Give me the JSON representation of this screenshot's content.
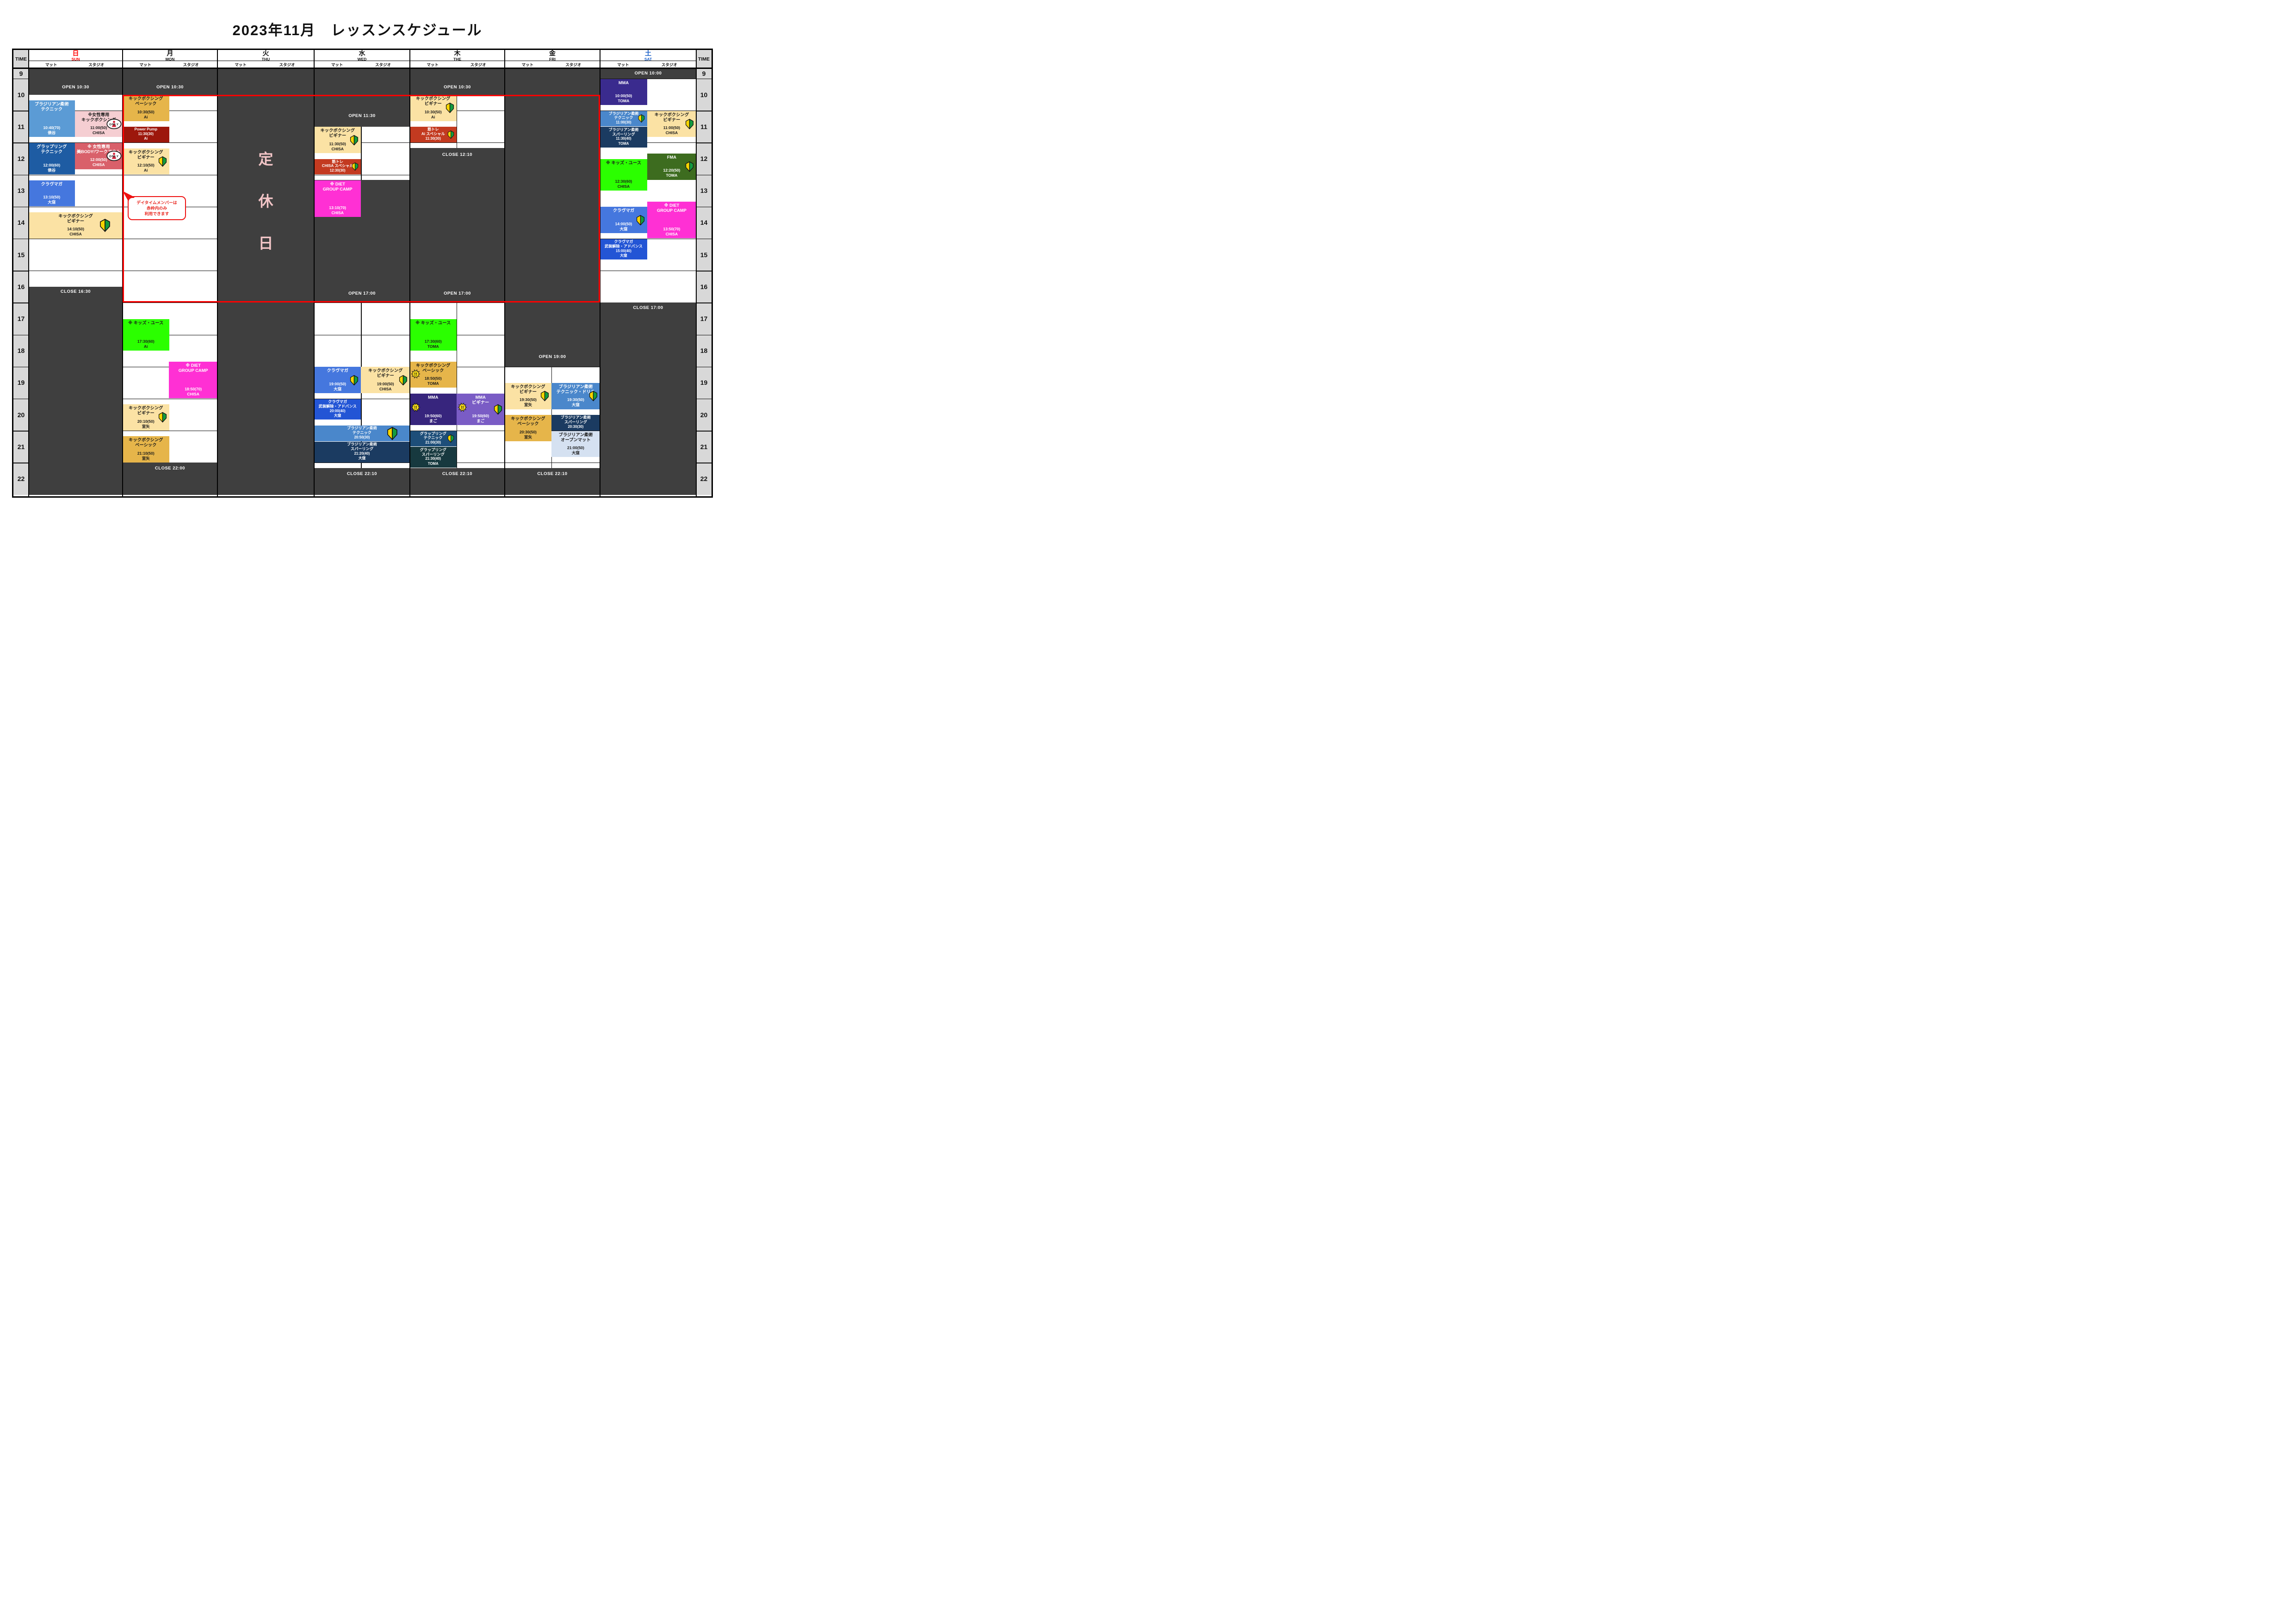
{
  "title": "2023年11月　レッスンスケジュール",
  "header": {
    "time_label": "TIME",
    "mat_label": "マット",
    "studio_label": "スタジオ"
  },
  "hours": [
    9,
    10,
    11,
    12,
    13,
    14,
    15,
    16,
    17,
    18,
    19,
    20,
    21,
    22
  ],
  "colors": {
    "dark_cell": "#3F3F3F",
    "time_col_bg": "#D8D8D8",
    "grid_line": "#101010",
    "red_frame": "#FF0000",
    "holiday_text": "#F2C5C7",
    "beginner_yellow": "#F7D500",
    "beginner_green": "#149B3E",
    "bang_yellow": "#FFE11A",
    "only_red": "#D7263D"
  },
  "icons": {
    "only_text": "ONLY",
    "bang_text": "!!"
  },
  "holiday": {
    "text": "定休日"
  },
  "callout": {
    "lines": [
      "デイタイムメンバーは",
      "赤枠内のみ",
      "利用できます"
    ],
    "color": "#E8231B"
  },
  "red_frame_note": {
    "from_day": "mon",
    "to_day": "fri",
    "from_time": 10.5,
    "to_time": 17
  },
  "days": [
    {
      "key": "sun",
      "name": "日",
      "en": "SUN",
      "name_color": "#FF0000",
      "holiday": false,
      "dark_bands": [
        [
          9,
          10.5
        ],
        [
          16.5,
          23
        ]
      ],
      "labels": [
        {
          "text": "OPEN 10:30",
          "t": 10.28
        },
        {
          "text": "CLOSE 16:30",
          "t": 16.66
        }
      ],
      "dividers": [],
      "events": [
        {
          "col": "mat",
          "t": 10.667,
          "dur": 70,
          "bg": "#5B9BD5",
          "fg": "#FFFFFF",
          "title": [
            "ブラジリアン柔術",
            "テクニック"
          ],
          "time": "10:40(70)",
          "who": "俵谷",
          "icons": [],
          "compact": false
        },
        {
          "col": "studio",
          "t": 11.0,
          "dur": 50,
          "bg": "#F5CED2",
          "fg": "#1A1A1A",
          "title": [
            "※女性専用",
            "キックボクシング"
          ],
          "time": "11:00(50)",
          "who": "CHISA",
          "icons": [
            "only"
          ],
          "compact": false
        },
        {
          "col": "mat",
          "t": 12.0,
          "dur": 60,
          "bg": "#1E5CA3",
          "fg": "#FFFFFF",
          "title": [
            "グラップリング",
            "テクニック"
          ],
          "time": "12:00(60)",
          "who": "俵谷",
          "icons": [],
          "compact": false
        },
        {
          "col": "studio",
          "t": 12.0,
          "dur": 50,
          "bg": "#D9606A",
          "fg": "#FFFFFF",
          "title": [
            "※ 女性専用",
            "美BODY!ワークアウト"
          ],
          "time": "12:00(50)",
          "who": "CHISA",
          "icons": [
            "only"
          ],
          "compact": false
        },
        {
          "col": "mat",
          "t": 13.167,
          "dur": 50,
          "bg": "#4577DE",
          "fg": "#FFFFFF",
          "title": [
            "クラヴマガ"
          ],
          "time": "13:10(50)",
          "who": "大窪",
          "icons": [],
          "compact": false
        },
        {
          "col": "full",
          "t": 14.167,
          "dur": 50,
          "bg": "#FBE2A4",
          "fg": "#1A1A1A",
          "title": [
            "キックボクシング",
            "ビギナー"
          ],
          "time": "14:10(50)",
          "who": "CHISA",
          "icons": [
            "beginner"
          ],
          "compact": false
        }
      ]
    },
    {
      "key": "mon",
      "name": "月",
      "en": "MON",
      "name_color": "#111111",
      "holiday": false,
      "dark_bands": [
        [
          9,
          10.5
        ],
        [
          22,
          23
        ]
      ],
      "labels": [
        {
          "text": "OPEN 10:30",
          "t": 10.28
        },
        {
          "text": "CLOSE 22:00",
          "t": 22.18
        }
      ],
      "dividers": [],
      "events": [
        {
          "col": "mat",
          "t": 10.5,
          "dur": 50,
          "bg": "#E6B54A",
          "fg": "#1A1A1A",
          "title": [
            "キックボクシング",
            "ベーシック"
          ],
          "time": "10:30(50)",
          "who": "Ai",
          "icons": [],
          "compact": false
        },
        {
          "col": "mat",
          "t": 11.5,
          "dur": 30,
          "bg": "#9D170C",
          "fg": "#FFFFFF",
          "title": [
            "Power Pump"
          ],
          "time": "11:30(30)",
          "who": "Ai",
          "icons": [],
          "compact": true
        },
        {
          "col": "mat",
          "t": 12.167,
          "dur": 50,
          "bg": "#FBE2A4",
          "fg": "#1A1A1A",
          "title": [
            "キックボクシング",
            "ビギナー"
          ],
          "time": "12:10(50)",
          "who": "Ai",
          "icons": [
            "beginner"
          ],
          "compact": false
        },
        {
          "col": "mat",
          "t": 17.5,
          "dur": 60,
          "bg": "#2BFF00",
          "fg": "#1A1A1A",
          "title": [
            "※ キッズ・ユース"
          ],
          "time": "17:30(60)",
          "who": "Ai",
          "icons": [],
          "compact": false
        },
        {
          "col": "studio",
          "t": 18.833,
          "dur": 70,
          "bg": "#FF30D4",
          "fg": "#FFFFFF",
          "title": [
            "※ DIET",
            "GROUP CAMP"
          ],
          "time": "18:50(70)",
          "who": "CHISA",
          "icons": [],
          "compact": false
        },
        {
          "col": "mat",
          "t": 20.167,
          "dur": 50,
          "bg": "#FBE2A4",
          "fg": "#1A1A1A",
          "title": [
            "キックボクシング",
            "ビギナー"
          ],
          "time": "20:10(50)",
          "who": "室矢",
          "icons": [
            "beginner"
          ],
          "compact": false
        },
        {
          "col": "mat",
          "t": 21.167,
          "dur": 50,
          "bg": "#E6B54A",
          "fg": "#1A1A1A",
          "title": [
            "キックボクシング",
            "ベーシック"
          ],
          "time": "21:10(50)",
          "who": "室矢",
          "icons": [],
          "compact": false
        }
      ]
    },
    {
      "key": "tue",
      "name": "火",
      "en": "THU",
      "name_color": "#111111",
      "holiday": true,
      "dark_bands": [
        [
          9,
          23
        ]
      ],
      "labels": [],
      "dividers": [],
      "events": []
    },
    {
      "key": "wed",
      "name": "水",
      "en": "WED",
      "name_color": "#111111",
      "holiday": false,
      "dark_bands": [
        [
          9,
          11.5
        ],
        [
          13.167,
          17
        ],
        [
          22.167,
          23
        ]
      ],
      "labels": [
        {
          "text": "OPEN 11:30",
          "t": 11.17
        },
        {
          "text": "OPEN 17:00",
          "t": 16.72
        },
        {
          "text": "CLOSE 22:10",
          "t": 22.35
        }
      ],
      "dividers": [
        [
          11.5,
          13.167
        ],
        [
          17,
          22.167
        ]
      ],
      "events": [
        {
          "col": "mat",
          "t": 11.5,
          "dur": 50,
          "bg": "#FBE2A4",
          "fg": "#1A1A1A",
          "title": [
            "キックボクシング",
            "ビギナー"
          ],
          "time": "11:30(50)",
          "who": "CHISA",
          "icons": [
            "beginner"
          ],
          "compact": false
        },
        {
          "col": "mat",
          "t": 12.5,
          "dur": 30,
          "bg": "#C33A20",
          "fg": "#FFFFFF",
          "title": [
            "筋トレ",
            "CHISA スペシャル"
          ],
          "time": "12:30(30)",
          "who": "",
          "icons": [
            "beginner"
          ],
          "compact": true
        },
        {
          "col": "mat",
          "t": 13.167,
          "dur": 70,
          "bg": "#FF30D4",
          "fg": "#FFFFFF",
          "title": [
            "※ DIET",
            "GROUP CAMP"
          ],
          "time": "13:10(70)",
          "who": "CHISA",
          "icons": [],
          "compact": false
        },
        {
          "col": "mat",
          "t": 19.0,
          "dur": 50,
          "bg": "#4577DE",
          "fg": "#FFFFFF",
          "title": [
            "クラヴマガ"
          ],
          "time": "19:00(50)",
          "who": "大窪",
          "icons": [
            "beginner"
          ],
          "compact": false
        },
        {
          "col": "studio",
          "t": 19.0,
          "dur": 50,
          "bg": "#FBE2A4",
          "fg": "#1A1A1A",
          "title": [
            "キックボクシング",
            "ビギナー"
          ],
          "time": "19:00(50)",
          "who": "CHISA",
          "icons": [
            "beginner"
          ],
          "compact": false
        },
        {
          "col": "mat",
          "t": 20.0,
          "dur": 40,
          "bg": "#2355D5",
          "fg": "#FFFFFF",
          "title": [
            "クラヴマガ",
            "武装解除・アドバンス"
          ],
          "time": "20:00(40)",
          "who": "大窪",
          "icons": [],
          "compact": true
        },
        {
          "col": "full",
          "t": 20.833,
          "dur": 30,
          "bg": "#4A87CB",
          "fg": "#FFFFFF",
          "title": [
            "ブラジリアン柔術",
            "テクニック"
          ],
          "time": "20:50(30)",
          "who": "",
          "icons": [
            "beginner"
          ],
          "compact": true
        },
        {
          "col": "full",
          "t": 21.333,
          "dur": 40,
          "bg": "#1B3B61",
          "fg": "#FFFFFF",
          "title": [
            "ブラジリアン柔術",
            "スパーリング"
          ],
          "time": "21:20(40)",
          "who": "大窪",
          "icons": [],
          "compact": true
        }
      ]
    },
    {
      "key": "thu",
      "name": "木",
      "en": "THE",
      "name_color": "#111111",
      "holiday": false,
      "dark_bands": [
        [
          9,
          10.5
        ],
        [
          12.167,
          17
        ],
        [
          22.167,
          23
        ]
      ],
      "labels": [
        {
          "text": "OPEN 10:30",
          "t": 10.28
        },
        {
          "text": "CLOSE 12:10",
          "t": 12.38
        },
        {
          "text": "OPEN 17:00",
          "t": 16.72
        },
        {
          "text": "CLOSE 22:10",
          "t": 22.35
        }
      ],
      "dividers": [
        [
          10.5,
          12.167
        ],
        [
          17,
          22.167
        ]
      ],
      "events": [
        {
          "col": "mat",
          "t": 10.5,
          "dur": 50,
          "bg": "#FBE2A4",
          "fg": "#1A1A1A",
          "title": [
            "キックボクシング",
            "ビギナー"
          ],
          "time": "10:30(50)",
          "who": "Ai",
          "icons": [
            "beginner"
          ],
          "compact": false
        },
        {
          "col": "mat",
          "t": 11.5,
          "dur": 30,
          "bg": "#C33A20",
          "fg": "#FFFFFF",
          "title": [
            "筋トレ",
            "Ai スペシャル"
          ],
          "time": "11:30(30)",
          "who": "",
          "icons": [
            "beginner"
          ],
          "compact": true
        },
        {
          "col": "mat",
          "t": 17.5,
          "dur": 60,
          "bg": "#2BFF00",
          "fg": "#1A1A1A",
          "title": [
            "※ キッズ・ユース"
          ],
          "time": "17:30(60)",
          "who": "TOMA",
          "icons": [],
          "compact": false
        },
        {
          "col": "mat",
          "t": 18.833,
          "dur": 50,
          "bg": "#E6B54A",
          "fg": "#1A1A1A",
          "title": [
            "キックボクシング",
            "ベーシック"
          ],
          "time": "18:50(50)",
          "who": "TOMA",
          "icons": [
            "bang"
          ],
          "compact": false
        },
        {
          "col": "mat",
          "t": 19.833,
          "dur": 60,
          "bg": "#37257D",
          "fg": "#FFFFFF",
          "title": [
            "MMA"
          ],
          "time": "19:50(60)",
          "who": "まご",
          "icons": [
            "bang"
          ],
          "compact": false
        },
        {
          "col": "studio",
          "t": 19.833,
          "dur": 60,
          "bg": "#7A5CC5",
          "fg": "#FFFFFF",
          "title": [
            "MMA",
            "ビギナー"
          ],
          "time": "19:50(60)",
          "who": "まご",
          "icons": [
            "bang",
            "beginner"
          ],
          "compact": false
        },
        {
          "col": "mat",
          "t": 21.0,
          "dur": 30,
          "bg": "#1D4E79",
          "fg": "#FFFFFF",
          "title": [
            "グラップリング",
            "テクニック"
          ],
          "time": "21:00(30)",
          "who": "",
          "icons": [
            "beginner"
          ],
          "compact": true
        },
        {
          "col": "mat",
          "t": 21.5,
          "dur": 40,
          "bg": "#17393F",
          "fg": "#FFFFFF",
          "title": [
            "グラップリング",
            "スパーリング"
          ],
          "time": "21:30(40)",
          "who": "TOMA",
          "icons": [],
          "compact": true
        }
      ]
    },
    {
      "key": "fri",
      "name": "金",
      "en": "FRI",
      "name_color": "#111111",
      "holiday": false,
      "dark_bands": [
        [
          9,
          19
        ],
        [
          22.167,
          23
        ]
      ],
      "labels": [
        {
          "text": "OPEN 19:00",
          "t": 18.7
        },
        {
          "text": "CLOSE 22:10",
          "t": 22.35
        }
      ],
      "dividers": [
        [
          19,
          22.167
        ]
      ],
      "events": [
        {
          "col": "mat",
          "t": 19.5,
          "dur": 50,
          "bg": "#FBE2A4",
          "fg": "#1A1A1A",
          "title": [
            "キックボクシング",
            "ビギナー"
          ],
          "time": "19:30(50)",
          "who": "室矢",
          "icons": [
            "beginner"
          ],
          "compact": false
        },
        {
          "col": "studio",
          "t": 19.5,
          "dur": 50,
          "bg": "#4A87CB",
          "fg": "#FFFFFF",
          "title": [
            "ブラジリアン柔術",
            "テクニック・ドリル"
          ],
          "time": "19:30(50)",
          "who": "大窪",
          "icons": [
            "beginner"
          ],
          "compact": false
        },
        {
          "col": "mat",
          "t": 20.5,
          "dur": 50,
          "bg": "#E6B54A",
          "fg": "#1A1A1A",
          "title": [
            "キックボクシング",
            "ベーシック"
          ],
          "time": "20:30(50)",
          "who": "室矢",
          "icons": [],
          "compact": false
        },
        {
          "col": "studio",
          "t": 20.5,
          "dur": 30,
          "bg": "#1B3B61",
          "fg": "#FFFFFF",
          "title": [
            "ブラジリアン柔術",
            "スパーリング"
          ],
          "time": "20:30(30)",
          "who": "",
          "icons": [],
          "compact": true
        },
        {
          "col": "studio",
          "t": 21.0,
          "dur": 50,
          "bg": "#D5E1F1",
          "fg": "#1A1A1A",
          "title": [
            "ブラジリアン柔術",
            "オープンマット"
          ],
          "time": "21:00(50)",
          "who": "大窪",
          "icons": [],
          "compact": false
        }
      ]
    },
    {
      "key": "sat",
      "name": "土",
      "en": "SAT",
      "name_color": "#1A5FC8",
      "holiday": false,
      "dark_bands": [
        [
          9,
          10
        ],
        [
          17,
          23
        ]
      ],
      "labels": [
        {
          "text": "OPEN 10:00",
          "t": 9.5
        },
        {
          "text": "CLOSE 17:00",
          "t": 17.16
        }
      ],
      "dividers": [],
      "events": [
        {
          "col": "mat",
          "t": 10.0,
          "dur": 50,
          "bg": "#3A2B8E",
          "fg": "#FFFFFF",
          "title": [
            "MMA"
          ],
          "time": "10:00(50)",
          "who": "TOMA",
          "icons": [],
          "compact": false
        },
        {
          "col": "mat",
          "t": 11.0,
          "dur": 30,
          "bg": "#4A87CB",
          "fg": "#FFFFFF",
          "title": [
            "ブラジリアン柔術",
            "テクニック"
          ],
          "time": "11:00(30)",
          "who": "",
          "icons": [
            "beginner"
          ],
          "compact": true
        },
        {
          "col": "studio",
          "t": 11.0,
          "dur": 50,
          "bg": "#FBE2A4",
          "fg": "#1A1A1A",
          "title": [
            "キックボクシング",
            "ビギナー"
          ],
          "time": "11:00(50)",
          "who": "CHISA",
          "icons": [
            "beginner"
          ],
          "compact": false
        },
        {
          "col": "mat",
          "t": 11.5,
          "dur": 40,
          "bg": "#1B3B61",
          "fg": "#FFFFFF",
          "title": [
            "ブラジリアン柔術",
            "スパーリング"
          ],
          "time": "11:30(40)",
          "who": "TOMA",
          "icons": [],
          "compact": true
        },
        {
          "col": "studio",
          "t": 12.333,
          "dur": 50,
          "bg": "#3D6C1F",
          "fg": "#FFFFFF",
          "title": [
            "FMA"
          ],
          "time": "12:20(50)",
          "who": "TOMA",
          "icons": [
            "beginner"
          ],
          "compact": false
        },
        {
          "col": "mat",
          "t": 12.5,
          "dur": 60,
          "bg": "#2BFF00",
          "fg": "#1A1A1A",
          "title": [
            "※ キッズ・ユース"
          ],
          "time": "12:30(60)",
          "who": "CHISA",
          "icons": [],
          "compact": false
        },
        {
          "col": "studio",
          "t": 13.833,
          "dur": 70,
          "bg": "#FF30D4",
          "fg": "#FFFFFF",
          "title": [
            "※ DIET",
            "GROUP CAMP"
          ],
          "time": "13:50(70)",
          "who": "CHISA",
          "icons": [],
          "compact": false
        },
        {
          "col": "mat",
          "t": 14.0,
          "dur": 50,
          "bg": "#4577DE",
          "fg": "#FFFFFF",
          "title": [
            "クラヴマガ"
          ],
          "time": "14:00(50)",
          "who": "大窪",
          "icons": [
            "beginner"
          ],
          "compact": false
        },
        {
          "col": "mat",
          "t": 15.0,
          "dur": 40,
          "bg": "#2355D5",
          "fg": "#FFFFFF",
          "title": [
            "クラヴマガ",
            "武装解除・アドバンス"
          ],
          "time": "15:00(40)",
          "who": "大窪",
          "icons": [],
          "compact": true
        }
      ]
    }
  ]
}
